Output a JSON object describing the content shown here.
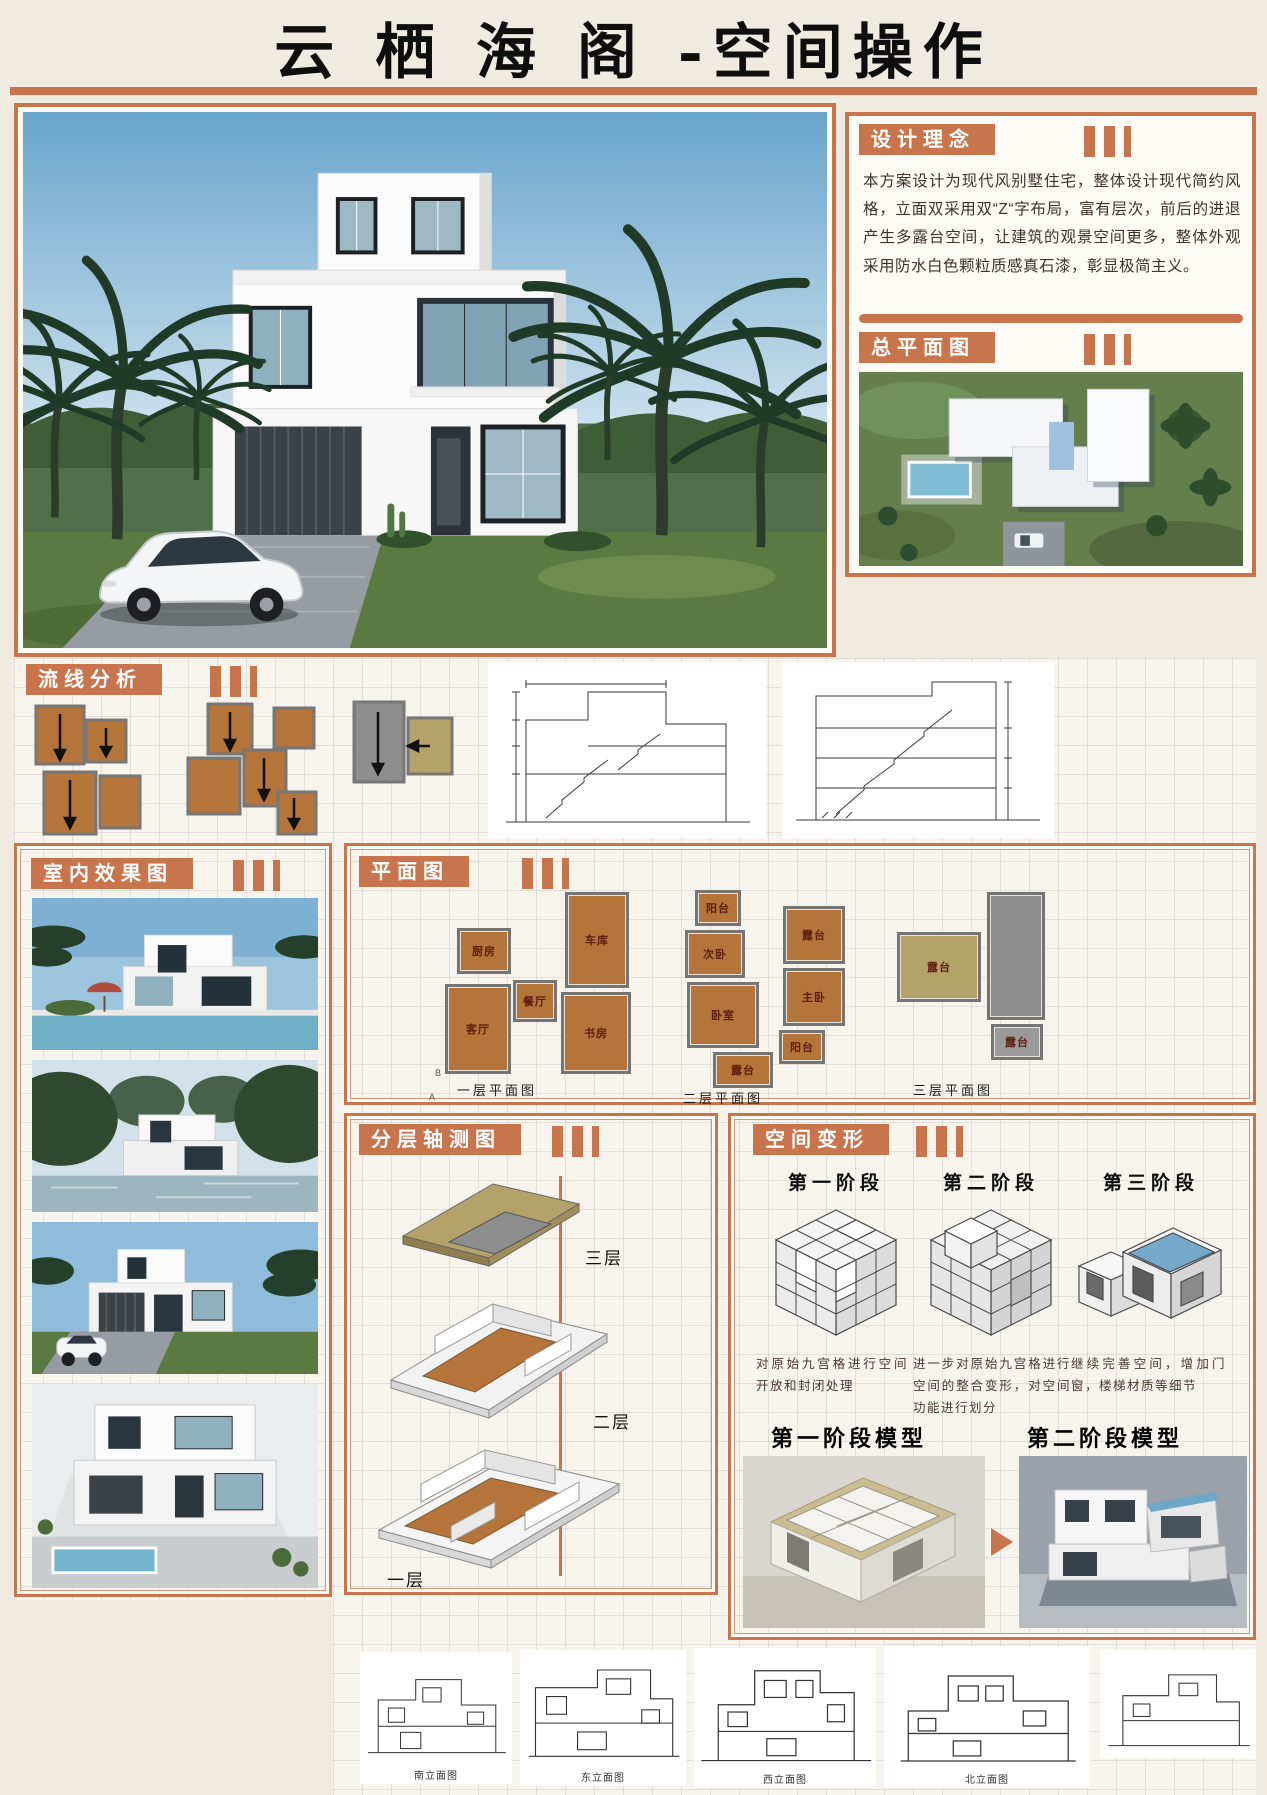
{
  "page": {
    "title": "云 栖 海 阁 -空间操作"
  },
  "colors": {
    "accent": "#c8754e",
    "plan_fill": "#b4743a",
    "terrace_tan": "#b3a269"
  },
  "design_concept": {
    "header": "设计理念",
    "body": "本方案设计为现代风别墅住宅，整体设计现代简约风格，立面双采用双“Z“字布局，富有层次，前后的进退产生多露台空间，让建筑的观景空间更多，整体外观采用防水白色颗粒质感真石漆，彰显极简主义。"
  },
  "site_plan": {
    "header": "总平面图"
  },
  "circulation": {
    "header": "流线分析"
  },
  "interior_renders": {
    "header": "室内效果图"
  },
  "floor_plans": {
    "header": "平面图",
    "plans": [
      {
        "caption": "一层平面图",
        "markers": {
          "top": "B",
          "bottom": "A"
        },
        "rooms": [
          "厨房",
          "车库",
          "餐厅",
          "书房",
          "客厅"
        ]
      },
      {
        "caption": "二层平面图",
        "rooms": [
          "阳台",
          "露台",
          "次卧",
          "卧室",
          "主卧",
          "露台",
          "阳台"
        ]
      },
      {
        "caption": "三层平面图",
        "rooms": [
          "露台",
          "露台"
        ]
      }
    ]
  },
  "axonometric": {
    "header": "分层轴测图",
    "levels": [
      "三层",
      "二层",
      "一层"
    ]
  },
  "transformation": {
    "header": "空间变形",
    "stages": [
      {
        "label": "第一阶段",
        "desc": "对原始九宫格进行空间开放和封闭处理"
      },
      {
        "label": "第二阶段",
        "desc": "进一步对原始九宫格进行空间的整合变形，对空间功能进行划分"
      },
      {
        "label": "第三阶段",
        "desc": "继续完善空间，增加门窗，楼梯材质等细节"
      }
    ],
    "models": [
      {
        "label": "第一阶段模型"
      },
      {
        "label": "第二阶段模型"
      }
    ]
  },
  "elevations": [
    {
      "caption": "南立面图"
    },
    {
      "caption": "东立面图"
    },
    {
      "caption": "西立面图"
    },
    {
      "caption": "北立面图"
    }
  ]
}
